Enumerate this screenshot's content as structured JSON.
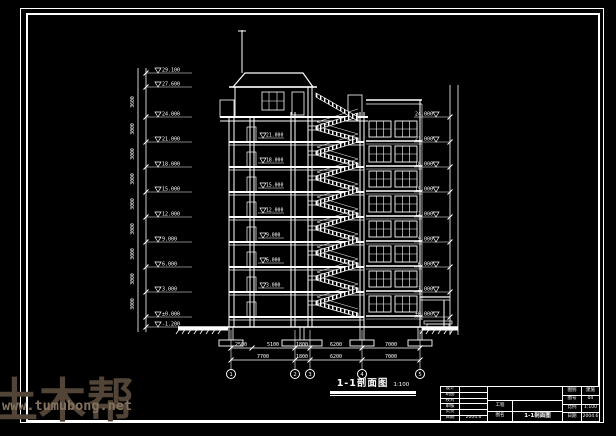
{
  "colors": {
    "background": "#000000",
    "line": "#ffffff",
    "watermark_brand": "#524436",
    "watermark_url": "#83725e"
  },
  "watermark": {
    "brand": "土木帮",
    "url": "www.tumubong.net"
  },
  "drawing": {
    "title": "1-1剖面图",
    "scale_note": "1:100",
    "left_levels": [
      {
        "y": 73,
        "label": "29.100"
      },
      {
        "y": 87,
        "label": "27.600"
      },
      {
        "y": 117,
        "label": "24.000"
      },
      {
        "y": 142,
        "label": "21.000"
      },
      {
        "y": 167,
        "label": "18.000"
      },
      {
        "y": 192,
        "label": "15.000"
      },
      {
        "y": 217,
        "label": "12.000"
      },
      {
        "y": 242,
        "label": "9.000"
      },
      {
        "y": 267,
        "label": "6.000"
      },
      {
        "y": 292,
        "label": "3.000"
      },
      {
        "y": 317,
        "label": "±0.000"
      },
      {
        "y": 327,
        "label": "-1.200"
      }
    ],
    "left_story_dims": [
      {
        "y": 102,
        "label": "3600"
      },
      {
        "y": 129,
        "label": "3000"
      },
      {
        "y": 154,
        "label": "3000"
      },
      {
        "y": 179,
        "label": "3000"
      },
      {
        "y": 204,
        "label": "3000"
      },
      {
        "y": 229,
        "label": "3000"
      },
      {
        "y": 254,
        "label": "3000"
      },
      {
        "y": 279,
        "label": "3000"
      },
      {
        "y": 304,
        "label": "3000"
      }
    ],
    "right_levels": [
      {
        "y": 117,
        "label": "24.000"
      },
      {
        "y": 142,
        "label": "21.000"
      },
      {
        "y": 167,
        "label": "18.000"
      },
      {
        "y": 192,
        "label": "15.000"
      },
      {
        "y": 217,
        "label": "12.000"
      },
      {
        "y": 242,
        "label": "9.000"
      },
      {
        "y": 267,
        "label": "6.000"
      },
      {
        "y": 292,
        "label": "3.000"
      },
      {
        "y": 317,
        "label": "±0.000"
      }
    ],
    "floor_flags": [
      {
        "y": 142,
        "label": "21.000"
      },
      {
        "y": 167,
        "label": "18.000"
      },
      {
        "y": 192,
        "label": "15.000"
      },
      {
        "y": 217,
        "label": "12.000"
      },
      {
        "y": 242,
        "label": "9.000"
      },
      {
        "y": 267,
        "label": "6.000"
      },
      {
        "y": 292,
        "label": "3.000"
      }
    ],
    "dims_row1": [
      {
        "x": 241,
        "label": "2500"
      },
      {
        "x": 273,
        "label": "5100"
      },
      {
        "x": 302,
        "label": "1800"
      },
      {
        "x": 336,
        "label": "6200"
      },
      {
        "x": 391,
        "label": "7000"
      }
    ],
    "dims_row2": [
      {
        "x": 263,
        "label": "7700"
      },
      {
        "x": 302,
        "label": "1800"
      },
      {
        "x": 336,
        "label": "6200"
      },
      {
        "x": 391,
        "label": "7000"
      }
    ],
    "axes": [
      {
        "x": 231,
        "label": "1"
      },
      {
        "x": 295,
        "label": "2"
      },
      {
        "x": 310,
        "label": "3"
      },
      {
        "x": 362,
        "label": "4"
      },
      {
        "x": 420,
        "label": "5"
      }
    ]
  },
  "titleblock": {
    "left_rows": [
      {
        "label": "设计",
        "value": ""
      },
      {
        "label": "制图",
        "value": ""
      },
      {
        "label": "校对",
        "value": ""
      },
      {
        "label": "审核",
        "value": ""
      },
      {
        "label": "负责",
        "value": ""
      },
      {
        "label": "日期",
        "value": "2004.6"
      }
    ],
    "firm_name": "",
    "project_label": "工程",
    "project_value": "",
    "sheet_label": "图名",
    "sheet_value": "1-1剖面图",
    "right_rows": [
      {
        "label": "图别",
        "value": "建施"
      },
      {
        "label": "图号",
        "value": "04"
      },
      {
        "label": "比例",
        "value": "1:100"
      },
      {
        "label": "日期",
        "value": "2004.6"
      }
    ]
  }
}
